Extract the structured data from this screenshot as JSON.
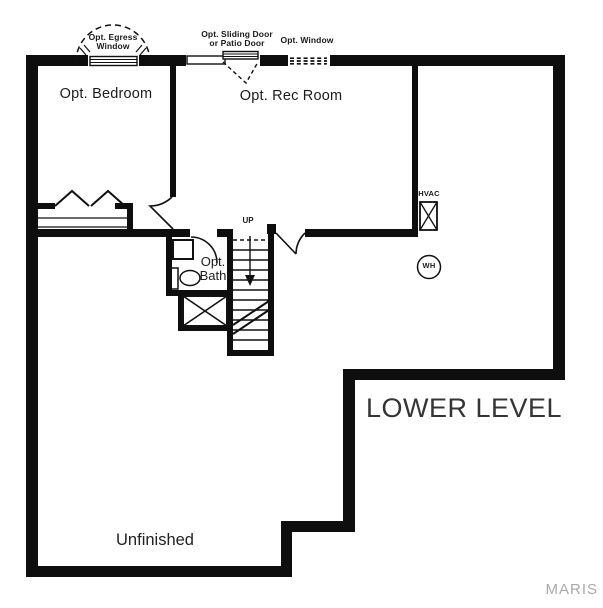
{
  "plan": {
    "title": "LOWER LEVEL",
    "watermark": "MARIS",
    "rooms": {
      "bedroom": "Opt. Bedroom",
      "rec_room": "Opt. Rec Room",
      "bath_line1": "Opt.",
      "bath_line2": "Bath",
      "unfinished": "Unfinished"
    },
    "annotations": {
      "egress_line1": "Opt. Egress",
      "egress_line2": "Window",
      "sliding_line1": "Opt. Sliding Door",
      "sliding_line2": "or Patio Door",
      "window": "Opt. Window",
      "stairs_up": "UP",
      "hvac": "HVAC",
      "water_heater": "WH"
    },
    "colors": {
      "wall": "#0e0e0e",
      "line": "#111111",
      "text": "#1a1a1a",
      "title_text": "#343434",
      "watermark": "#a9a9a9",
      "background": "#ffffff"
    }
  }
}
